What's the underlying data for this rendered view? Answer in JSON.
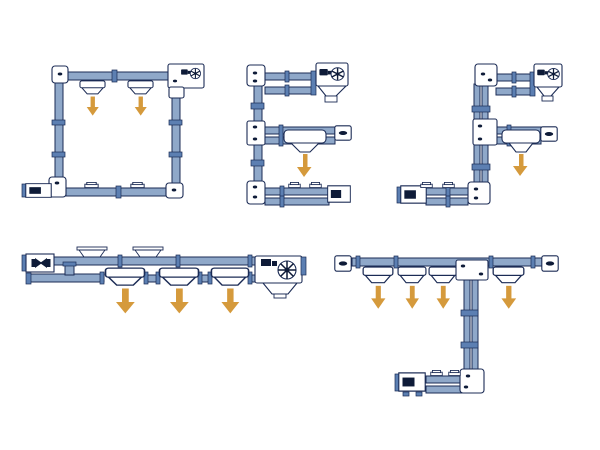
{
  "canvas": {
    "width": 600,
    "height": 450,
    "background": "#ffffff"
  },
  "colors": {
    "bg": "#ffffff",
    "tube": "#8fa8c9",
    "tube-dark": "#5c7fb2",
    "outline": "#1b2b55",
    "dark": "#0e1b38",
    "arrow": "#d59a3c"
  },
  "icons": [
    "motor-fan-icon",
    "discharge-down-arrow",
    "feed-inlet-box",
    "inlet-port",
    "end-cap",
    "corner-unit"
  ],
  "diagrams": [
    {
      "id": "rectangular-loop",
      "position": "top-left",
      "label": "Closed rectangular loop circuit: drive unit at top right, feed inlet box at bottom left, two discharge outlets with downward arrows on the top run, two inlet ports on the bottom run",
      "discharge_arrows": 2,
      "inlet_ports": 2,
      "inlet_boxes": 1,
      "drive_units": 1,
      "corner_units": 3
    },
    {
      "id": "e-shape",
      "position": "top-center",
      "label": "E-shaped circuit: vertical spine with three arms; drive unit with discharge hopper on top arm, discharge outlet with downward arrow on middle arm, feed inlet box and two inlet ports on bottom arm",
      "discharge_arrows": 1,
      "inlet_ports": 2,
      "inlet_boxes": 1,
      "drive_units": 1,
      "end_caps": 1
    },
    {
      "id": "f-shape",
      "position": "top-right",
      "label": "F-shaped circuit: vertical spine; drive unit with hopper on top arm, discharge outlet with downward arrow on middle arm, bottom-left feed foot with inlet box and two inlet ports",
      "discharge_arrows": 1,
      "inlet_ports": 2,
      "inlet_boxes": 1,
      "drive_units": 1,
      "end_caps": 1
    },
    {
      "id": "straight-run",
      "position": "bottom-left",
      "label": "Straight horizontal run: tail unit with two top feed hoppers at left, three in-line discharge outlets with downward arrows, drive unit with fan motor and hopper at right",
      "discharge_arrows": 3,
      "feed_hoppers": 2,
      "drive_units": 1
    },
    {
      "id": "t-shape",
      "position": "bottom-right",
      "label": "T-shaped circuit: top run with end caps and four discharge outlets with downward arrows, central junction with vertical drop leg down to a bottom feed foot with inlet box and two inlet ports",
      "discharge_arrows": 4,
      "inlet_ports": 2,
      "inlet_boxes": 1,
      "end_caps": 2
    }
  ]
}
